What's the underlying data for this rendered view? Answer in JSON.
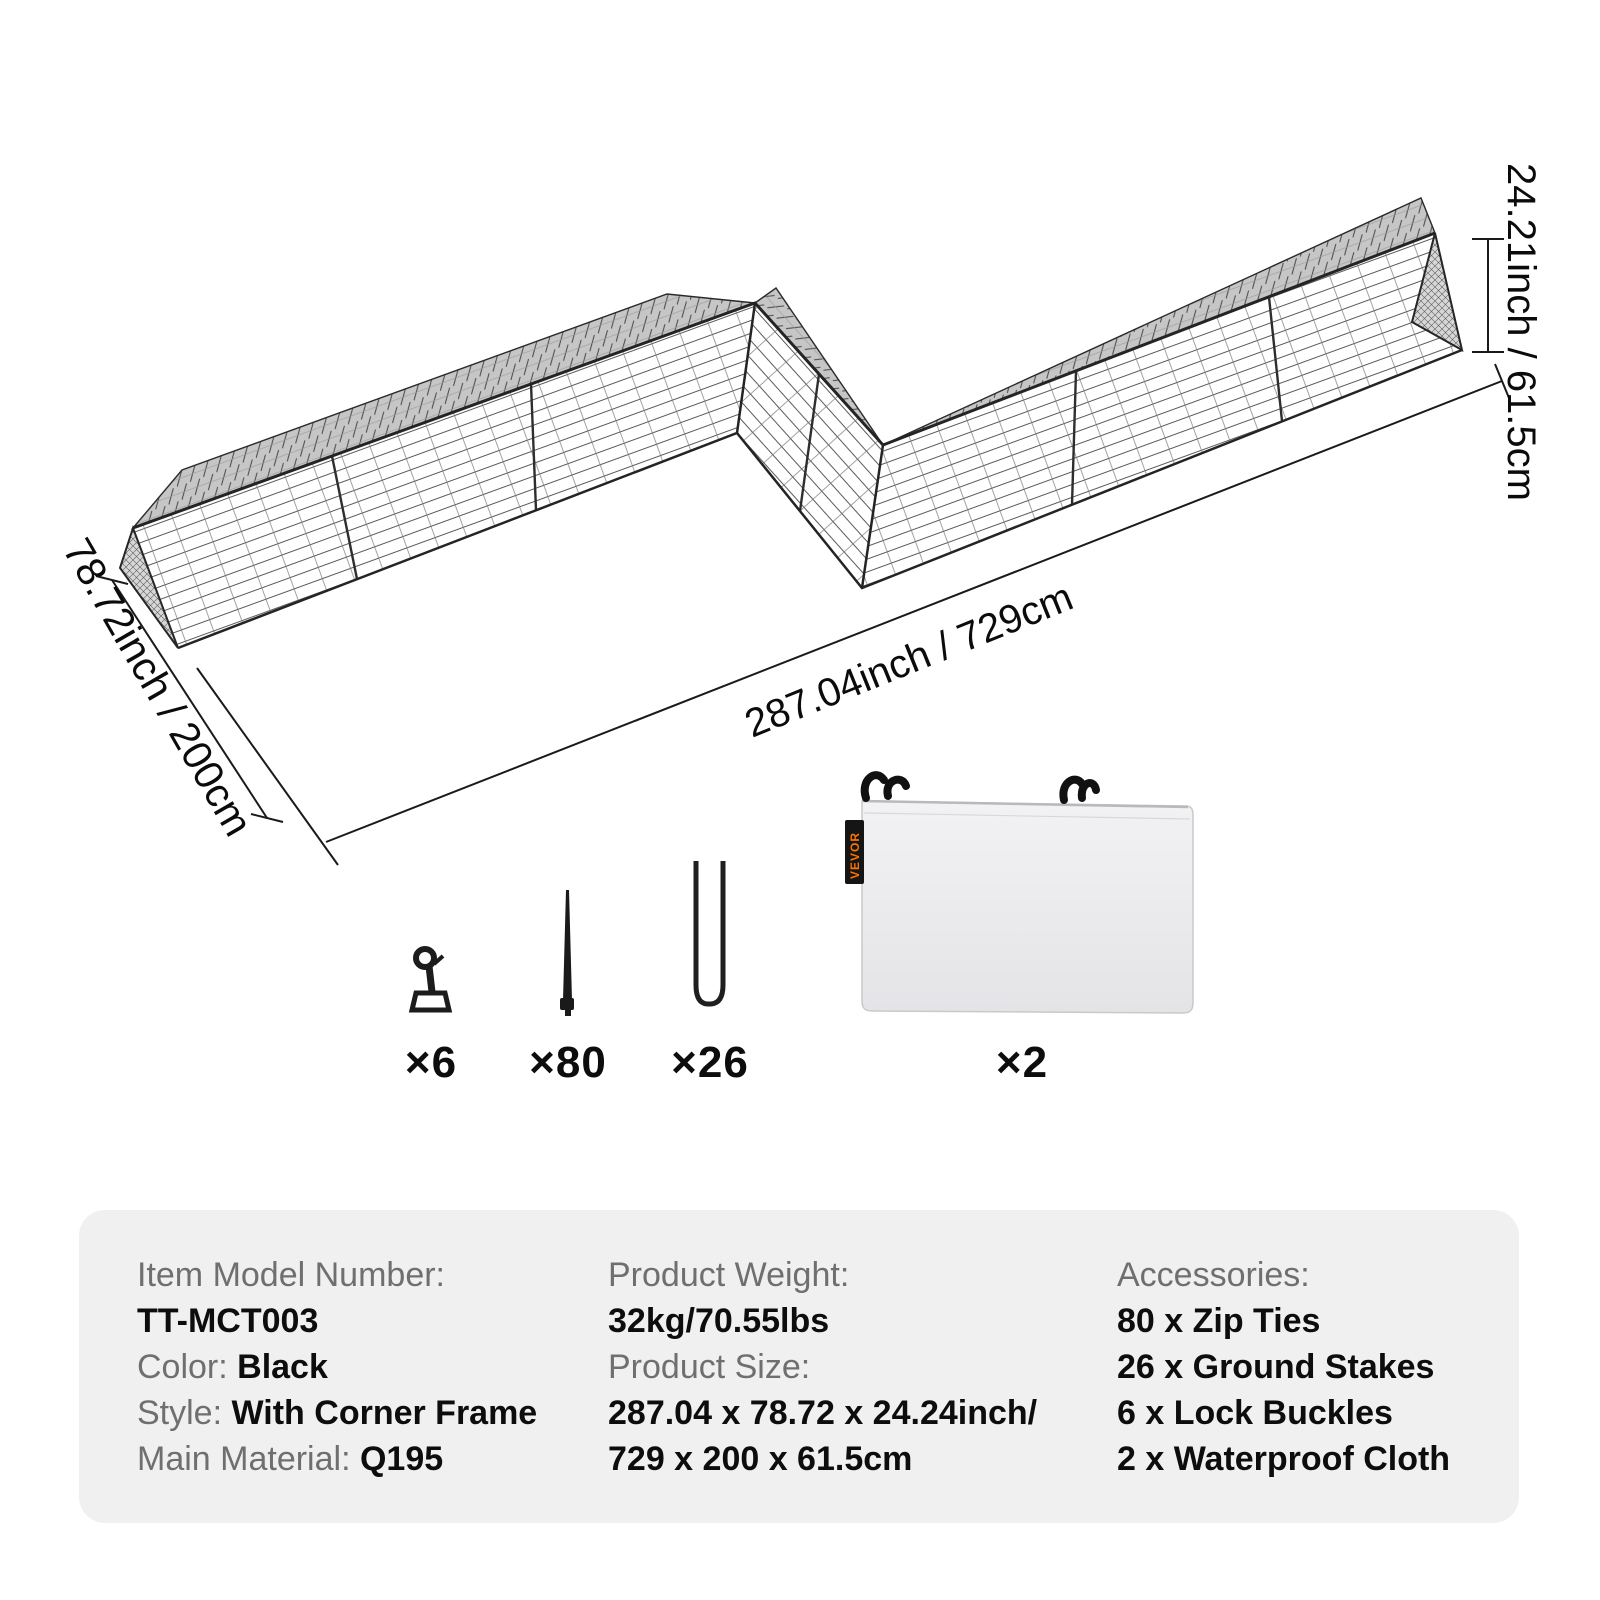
{
  "diagram": {
    "width_label": "78.72inch / 200cm",
    "length_label": "287.04inch / 729cm",
    "height_label": "24.21inch / 61.5cm"
  },
  "accessories": {
    "items": [
      {
        "name": "lock-buckle",
        "count": "×6"
      },
      {
        "name": "zip-tie",
        "count": "×80"
      },
      {
        "name": "ground-stake",
        "count": "×26"
      },
      {
        "name": "waterproof-cloth",
        "count": "×2"
      }
    ],
    "cloth_brand_tag": "VEVOR"
  },
  "spec_panel": {
    "columns": [
      {
        "lines": [
          {
            "label": "Item Model Number:",
            "value": ""
          },
          {
            "label": "",
            "value": "TT-MCT003"
          },
          {
            "label": "Color: ",
            "value": "Black"
          },
          {
            "label": "Style: ",
            "value": "With Corner Frame"
          },
          {
            "label": "Main Material: ",
            "value": "Q195"
          }
        ]
      },
      {
        "lines": [
          {
            "label": "Product Weight:",
            "value": ""
          },
          {
            "label": "",
            "value": "32kg/70.55lbs"
          },
          {
            "label": "Product Size:",
            "value": ""
          },
          {
            "label": "",
            "value": "287.04 x 78.72 x 24.24inch/"
          },
          {
            "label": "",
            "value": "729 x 200 x 61.5cm"
          }
        ]
      },
      {
        "lines": [
          {
            "label": "Accessories:",
            "value": ""
          },
          {
            "label": "",
            "value": "80 x Zip Ties"
          },
          {
            "label": "",
            "value": "26 x Ground Stakes"
          },
          {
            "label": "",
            "value": "6 x Lock Buckles"
          },
          {
            "label": "",
            "value": "2 x Waterproof Cloth"
          }
        ]
      }
    ]
  },
  "colors": {
    "panel_bg": "#f0f0f0",
    "label_gray": "#6f6f6f",
    "value_black": "#0d0d0d",
    "line_color": "#1a1a1a",
    "mesh_band_gray": "#c6c6c6",
    "brand_orange": "#ff7300"
  }
}
